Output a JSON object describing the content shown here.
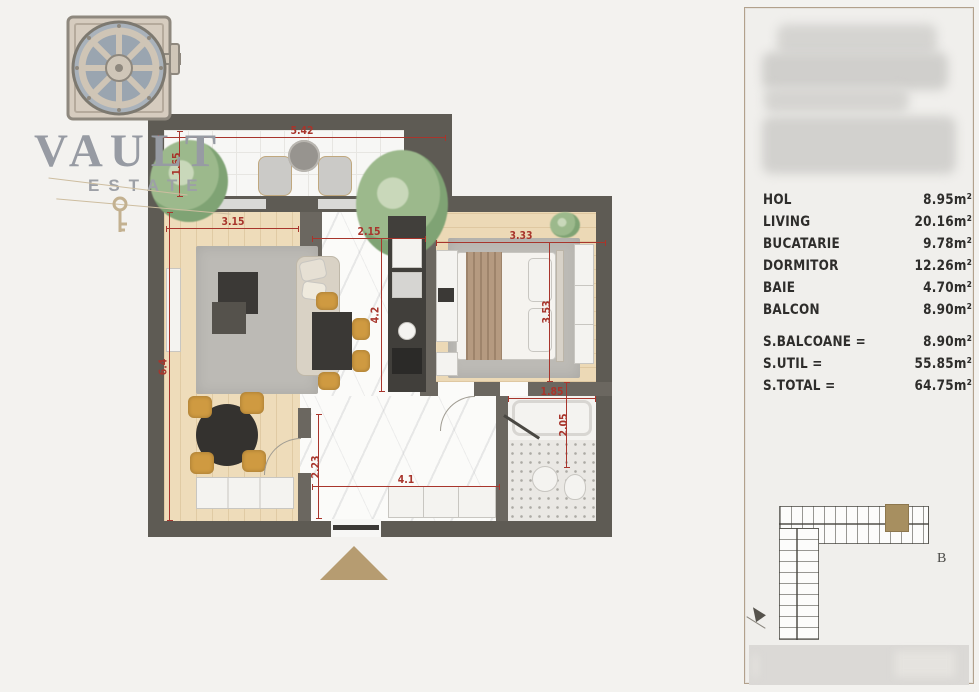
{
  "brand": {
    "name": "VAULT",
    "subtitle": "ESTATE"
  },
  "panel": {
    "rooms": [
      {
        "label": "HOL",
        "value": "8.95",
        "unit": "m²"
      },
      {
        "label": "LIVING",
        "value": "20.16",
        "unit": "m²"
      },
      {
        "label": "BUCATARIE",
        "value": "9.78",
        "unit": "m²"
      },
      {
        "label": "DORMITOR",
        "value": "12.26",
        "unit": "m²"
      },
      {
        "label": "BAIE",
        "value": "4.70",
        "unit": "m²"
      },
      {
        "label": "BALCON",
        "value": "8.90",
        "unit": "m²"
      }
    ],
    "totals": [
      {
        "label": "S.BALCOANE =",
        "value": "8.90",
        "unit": "m²"
      },
      {
        "label": "S.UTIL =",
        "value": "55.85",
        "unit": "m²"
      },
      {
        "label": "S.TOTAL =",
        "value": "64.75",
        "unit": "m²"
      }
    ],
    "site": {
      "block_label": "B"
    }
  },
  "plan": {
    "dimensions": {
      "balcony_width": "5.42",
      "balcony_depth": "1.65",
      "living_width": "3.15",
      "living_depth": "6.4",
      "kitchen_width": "2.15",
      "kitchen_depth": "4.2",
      "bedroom_width": "3.33",
      "bedroom_depth": "3.53",
      "hall_width": "4.1",
      "hall_depth": "2.23",
      "bath_width": "1.85",
      "bath_depth": "2.05"
    }
  },
  "colors": {
    "dimension_red": "#a8352c",
    "wall_grey": "#5e5b54",
    "accent_tan": "#b69c71",
    "chair_mustard": "#cf9a41",
    "site_unit_highlight": "#a78f60",
    "logo_grey": "#979ba3"
  }
}
